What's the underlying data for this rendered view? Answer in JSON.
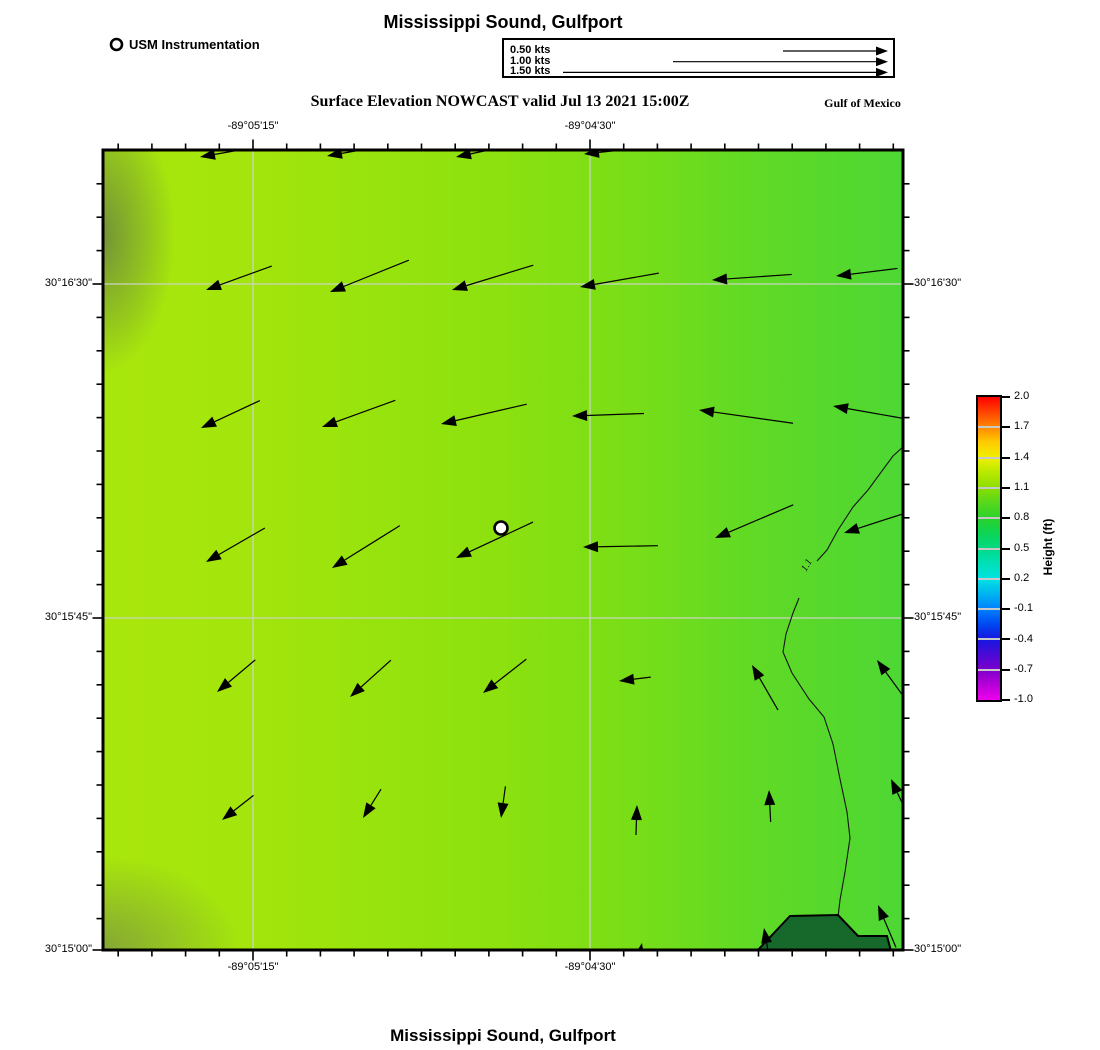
{
  "title_top": "Mississippi Sound, Gulfport",
  "title_bottom": "Mississippi Sound, Gulfport",
  "subtitle": "Surface Elevation NOWCAST valid Jul 13 2021 15:00Z",
  "region_label": "Gulf of Mexico",
  "legend": {
    "marker_label": "USM Instrumentation"
  },
  "velocity_legend": {
    "items": [
      {
        "label": "0.50 kts",
        "length_px": 105
      },
      {
        "label": "1.00 kts",
        "length_px": 215
      },
      {
        "label": "1.50 kts",
        "length_px": 325
      }
    ]
  },
  "axes": {
    "x_labels": [
      {
        "text": "-89°05'15\"",
        "x": 253
      },
      {
        "text": "-89°04'30\"",
        "x": 590
      }
    ],
    "y_labels": [
      {
        "text": "30°16'30\"",
        "y": 284
      },
      {
        "text": "30°15'45\"",
        "y": 618
      },
      {
        "text": "30°15'00\"",
        "y": 950
      }
    ]
  },
  "colorbar": {
    "title": "Height (ft)",
    "ticks": [
      "2.0",
      "1.7",
      "1.4",
      "1.1",
      "0.8",
      "0.5",
      "0.2",
      "-0.1",
      "-0.4",
      "-0.7",
      "-1.0"
    ]
  },
  "chart_data": {
    "type": "heatmap",
    "title": "Surface Elevation NOWCAST valid Jul 13 2021 15:00Z",
    "region": "Mississippi Sound, Gulfport",
    "field": "surface elevation with current vectors",
    "units": "ft",
    "colorbar_range": [
      -1.0,
      2.0
    ],
    "colorbar_ticks": [
      2.0,
      1.7,
      1.4,
      1.1,
      0.8,
      0.5,
      0.2,
      -0.1,
      -0.4,
      -0.7,
      -1.0
    ],
    "displayed_field_values_ft": [
      1.0,
      1.2
    ],
    "lon_ticks": [
      "-89°05'15\"",
      "-89°04'30\""
    ],
    "lat_ticks": [
      "30°16'30\"",
      "30°15'45\"",
      "30°15'00\""
    ],
    "station": {
      "label": "USM Instrumentation",
      "x": 501,
      "y": 528
    },
    "contour": {
      "value": 1.1,
      "label": "1.1",
      "label_pos": {
        "x": 806,
        "y": 572,
        "rotate_deg": -60
      },
      "segments": [
        [
          [
            905,
            445
          ],
          [
            893,
            456
          ],
          [
            868,
            490
          ],
          [
            853,
            507
          ],
          [
            838,
            530
          ],
          [
            827,
            550
          ],
          [
            817,
            561
          ]
        ],
        [
          [
            799,
            598
          ],
          [
            793,
            613
          ],
          [
            786,
            634
          ],
          [
            783,
            652
          ],
          [
            792,
            673
          ],
          [
            809,
            699
          ],
          [
            824,
            717
          ],
          [
            833,
            744
          ],
          [
            840,
            779
          ],
          [
            847,
            812
          ],
          [
            850,
            838
          ],
          [
            845,
            872
          ],
          [
            840,
            900
          ],
          [
            838,
            917
          ]
        ]
      ]
    },
    "land_polygon_px": [
      [
        757,
        951
      ],
      [
        790,
        916
      ],
      [
        838,
        915
      ],
      [
        858,
        936
      ],
      [
        887,
        936
      ],
      [
        891,
        951
      ]
    ],
    "vectors": {
      "speed_scale": [
        {
          "kts": 0.5,
          "px": 105
        },
        {
          "kts": 1.0,
          "px": 215
        },
        {
          "kts": 1.5,
          "px": 325
        }
      ],
      "note": "arrows as [head_x, head_y, direction_deg(0=E,90=N), length_px]",
      "arrows": [
        [
          200,
          157,
          190,
          50
        ],
        [
          327,
          156,
          190,
          55
        ],
        [
          456,
          157,
          192,
          58
        ],
        [
          584,
          154,
          186,
          45
        ],
        [
          206,
          290,
          200,
          70
        ],
        [
          330,
          292,
          202,
          85
        ],
        [
          452,
          290,
          197,
          85
        ],
        [
          580,
          287,
          190,
          80
        ],
        [
          712,
          280,
          184,
          80
        ],
        [
          836,
          276,
          187,
          62
        ],
        [
          201,
          428,
          205,
          65
        ],
        [
          322,
          427,
          200,
          78
        ],
        [
          441,
          424,
          193,
          88
        ],
        [
          572,
          416,
          182,
          72
        ],
        [
          699,
          410,
          172,
          95
        ],
        [
          833,
          406,
          170,
          100
        ],
        [
          206,
          562,
          210,
          68
        ],
        [
          332,
          568,
          212,
          80
        ],
        [
          456,
          558,
          205,
          85
        ],
        [
          583,
          547,
          181,
          75
        ],
        [
          715,
          538,
          203,
          85
        ],
        [
          844,
          533,
          198,
          88
        ],
        [
          217,
          692,
          220,
          50
        ],
        [
          350,
          697,
          222,
          55
        ],
        [
          483,
          693,
          218,
          55
        ],
        [
          619,
          681,
          187,
          32
        ],
        [
          752,
          665,
          120,
          52
        ],
        [
          877,
          660,
          126,
          56
        ],
        [
          222,
          820,
          218,
          40
        ],
        [
          363,
          818,
          238,
          34
        ],
        [
          501,
          818,
          262,
          32
        ],
        [
          637,
          805,
          88,
          30
        ],
        [
          769,
          790,
          93,
          32
        ],
        [
          891,
          779,
          115,
          34
        ],
        [
          642,
          943,
          78,
          24
        ],
        [
          764,
          928,
          100,
          28
        ],
        [
          878,
          905,
          113,
          46
        ]
      ]
    }
  }
}
